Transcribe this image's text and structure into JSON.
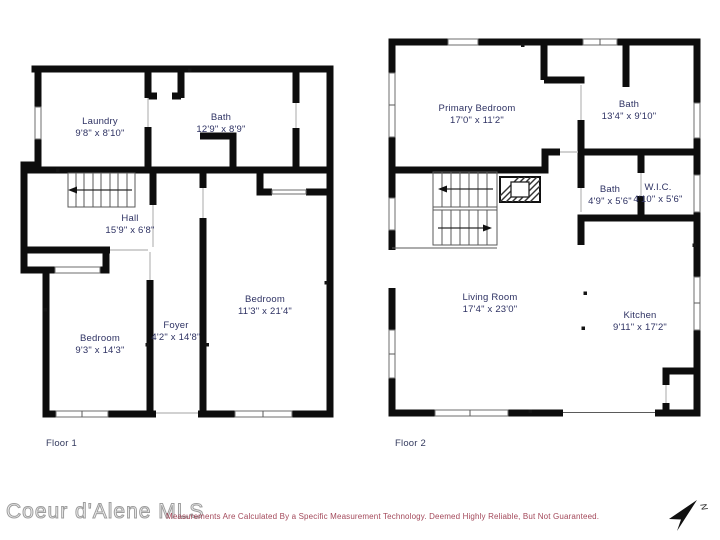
{
  "floors": [
    {
      "label": "Floor 1",
      "rooms": [
        {
          "name": "Laundry",
          "dims": "9'8\" x 8'10\""
        },
        {
          "name": "Bath",
          "dims": "12'9\" x 8'9\""
        },
        {
          "name": "Hall",
          "dims": "15'9\" x 6'8\""
        },
        {
          "name": "Bedroom",
          "dims": "11'3\" x 21'4\""
        },
        {
          "name": "Foyer",
          "dims": "4'2\" x 14'8\""
        },
        {
          "name": "Bedroom",
          "dims": "9'3\" x 14'3\""
        }
      ]
    },
    {
      "label": "Floor 2",
      "rooms": [
        {
          "name": "Primary Bedroom",
          "dims": "17'0\" x 11'2\""
        },
        {
          "name": "Bath",
          "dims": "13'4\" x 9'10\""
        },
        {
          "name": "Bath",
          "dims": "4'9\" x 5'6\""
        },
        {
          "name": "W.I.C.",
          "dims": "4'10\" x 5'6\""
        },
        {
          "name": "Living Room",
          "dims": "17'4\" x 23'0\""
        },
        {
          "name": "Kitchen",
          "dims": "9'11\" x 17'2\""
        }
      ]
    }
  ],
  "footer": {
    "watermark": "Coeur d'Alene MLS",
    "disclaimer": "Measurements Are Calculated By a Specific Measurement Technology. Deemed Highly Reliable, But Not Guaranteed.",
    "north_label": "N"
  },
  "colors": {
    "wall": "#0d0d0d",
    "room_label": "#2e3263",
    "disclaimer_text": "#a3485a",
    "watermark_outline": "#9d9d9d"
  }
}
